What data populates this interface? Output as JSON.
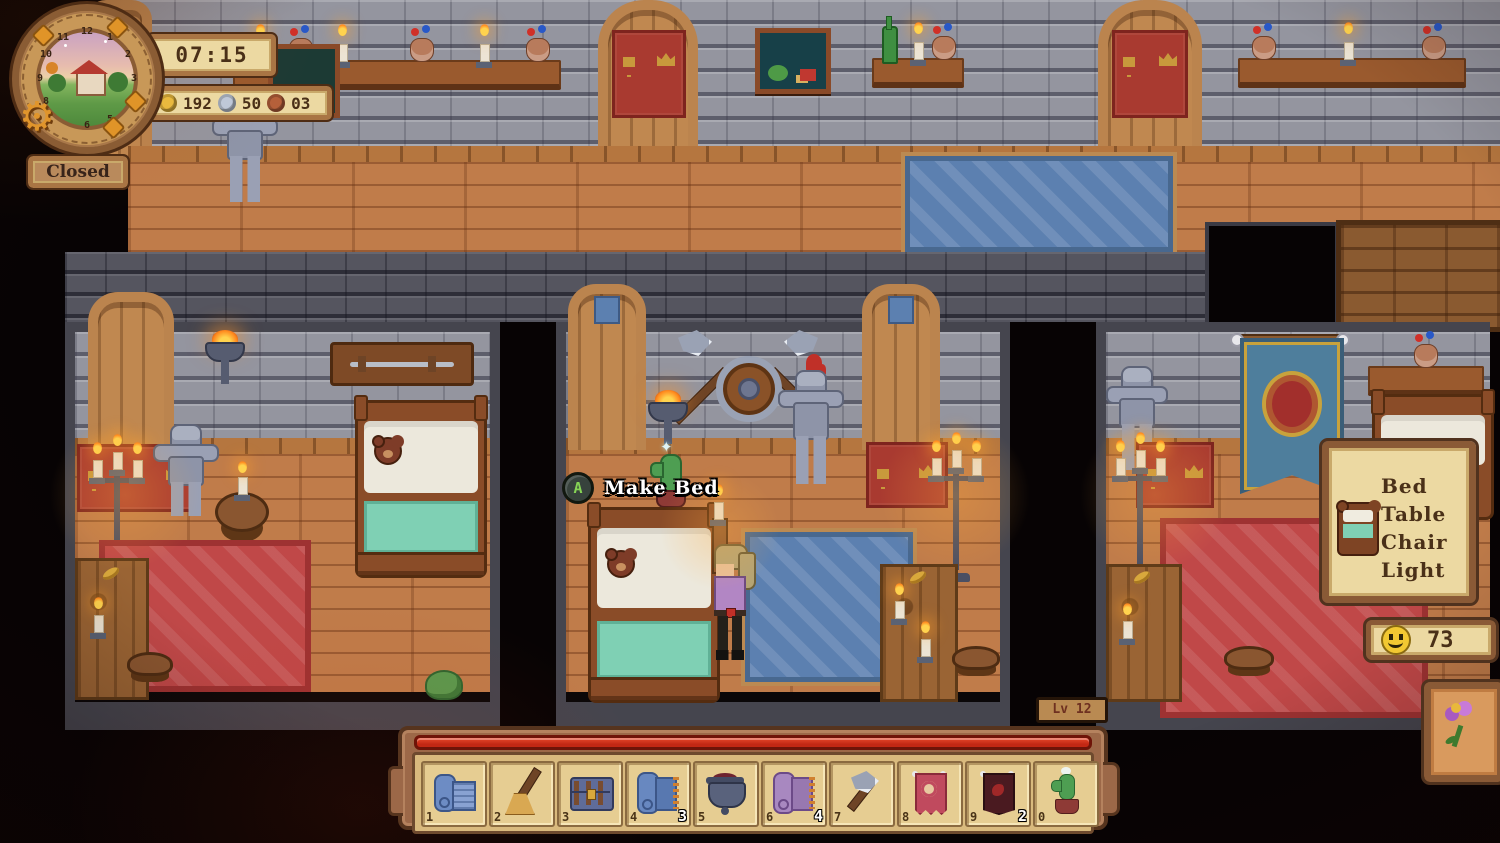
{
  "hud": {
    "clock": {
      "time": "07:15",
      "dial_numbers": [
        "12",
        "1",
        "2",
        "3",
        "4",
        "5",
        "6",
        "7",
        "8",
        "9",
        "10",
        "11"
      ],
      "status_sign": "Closed"
    },
    "currencies": [
      {
        "icon": "gold-coin-icon",
        "value": "192"
      },
      {
        "icon": "silver-coin-icon",
        "value": "50"
      },
      {
        "icon": "copper-coin-icon",
        "value": "03"
      }
    ],
    "interaction_prompt": {
      "gamepad_button": "A",
      "action": "Make Bed"
    },
    "level_badge": {
      "label": "Lv 12"
    },
    "requirements_panel": {
      "icon": "bed-icon",
      "lines": [
        "Bed",
        "Table",
        "Chair",
        "Light"
      ]
    },
    "happiness_counter": {
      "icon": "smiley-icon",
      "value": "73"
    },
    "decorate_button": {
      "icon": "flower-icon"
    },
    "hotbar": {
      "slots": [
        {
          "key": "1",
          "item": "blueprint-roll",
          "qty": ""
        },
        {
          "key": "2",
          "item": "broom",
          "qty": ""
        },
        {
          "key": "3",
          "item": "chest",
          "qty": ""
        },
        {
          "key": "4",
          "item": "blue-rug-roll",
          "qty": "3"
        },
        {
          "key": "5",
          "item": "cooking-pot",
          "qty": ""
        },
        {
          "key": "6",
          "item": "purple-rug-roll",
          "qty": "4"
        },
        {
          "key": "7",
          "item": "axe",
          "qty": ""
        },
        {
          "key": "8",
          "item": "pink-banner",
          "qty": ""
        },
        {
          "key": "9",
          "item": "dark-banner",
          "qty": "2"
        },
        {
          "key": "0",
          "item": "cactus",
          "qty": ""
        }
      ]
    }
  },
  "colors": {
    "panel_fill": "#ecd9a2",
    "panel_frame": "#8a5a36",
    "progress_red": "#c92d18",
    "text_brown": "#4a3018",
    "coin_gold": "#e9b93e",
    "coin_silver": "#bfc8d8",
    "coin_copper": "#b5603a",
    "prompt_green": "#86d455",
    "smiley_yellow": "#f2c832",
    "rug_blue": "#5c80b0",
    "rug_red": "#c04848",
    "banner_red": "#a93a30"
  }
}
